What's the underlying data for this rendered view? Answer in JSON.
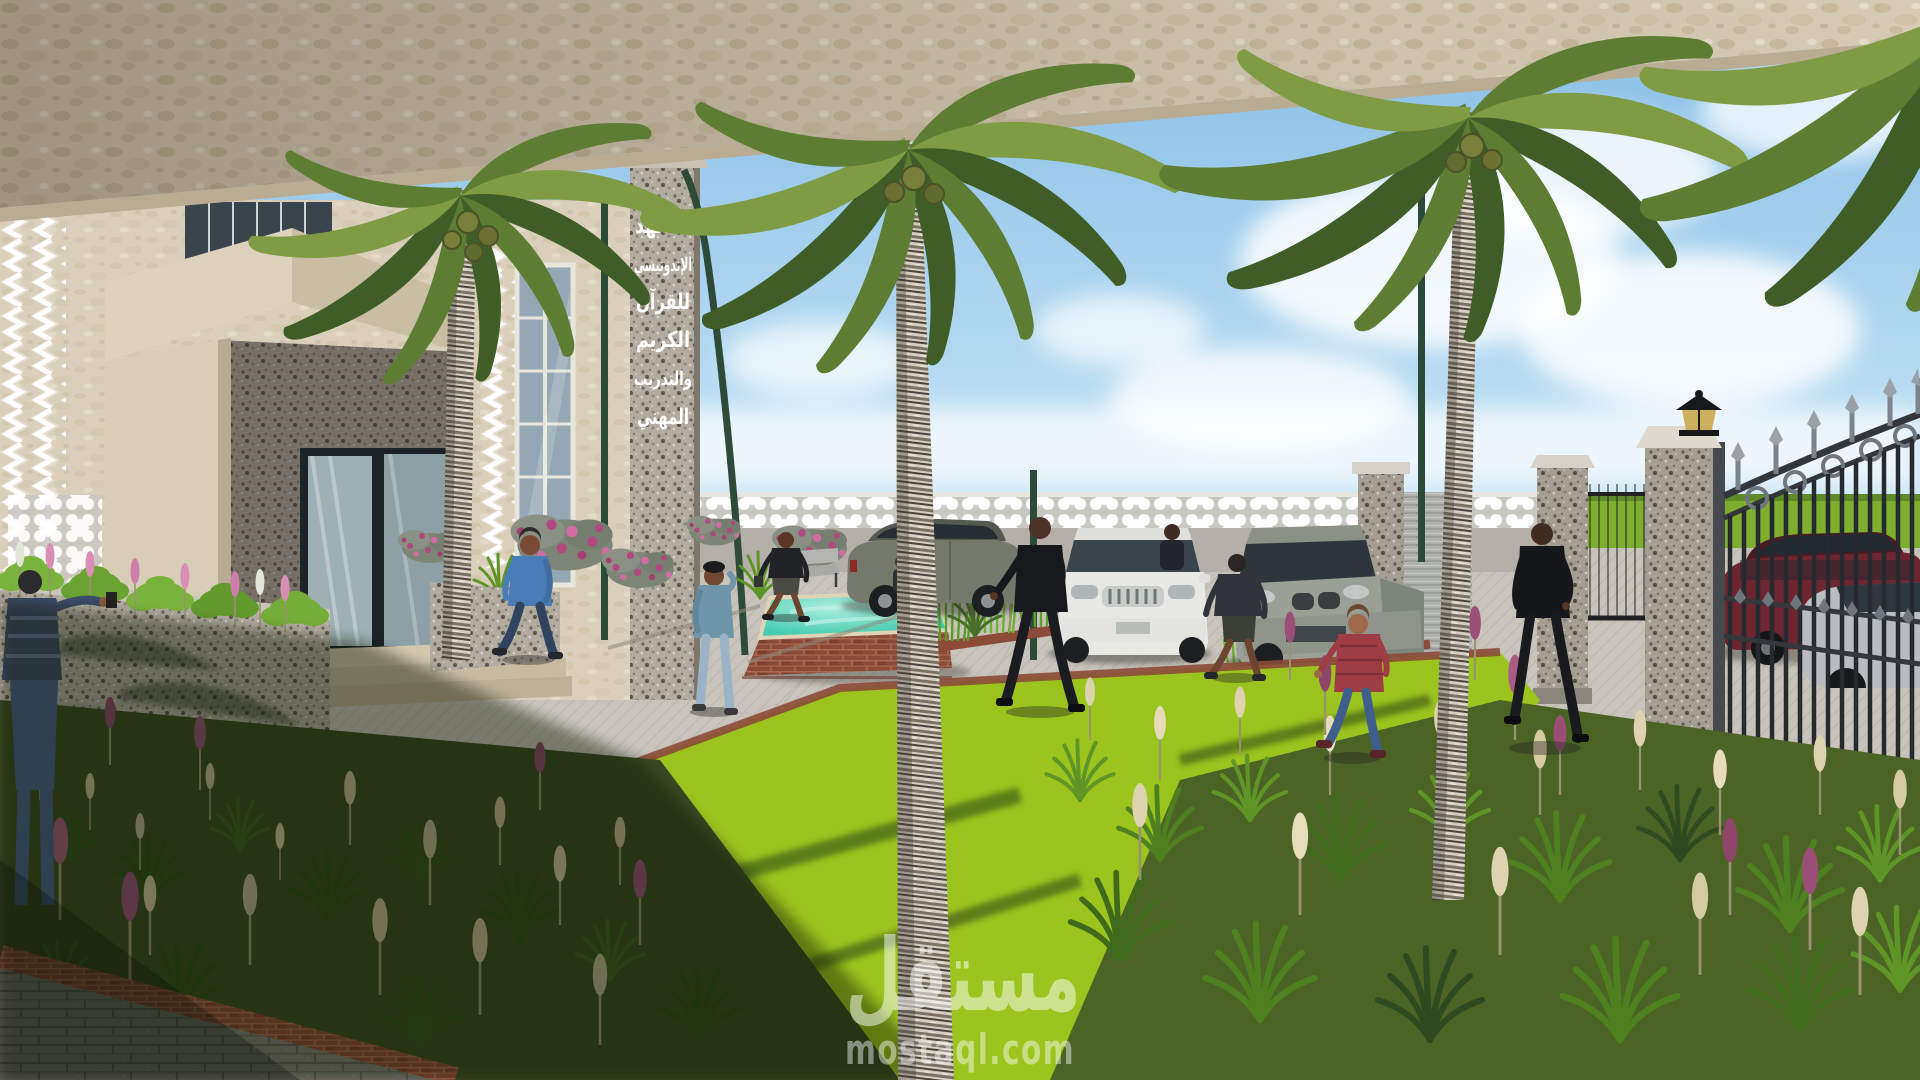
{
  "sign": {
    "words": [
      "المعهد",
      "الإندونيسي",
      "للقرآن",
      "الكريم",
      "والتدريب",
      "المهني"
    ]
  },
  "watermark": {
    "arabic": "مستقل",
    "latin": "mostaql.com"
  },
  "palette": {
    "sky_top": "#86bde6",
    "sky_horizon": "#e6f3fa",
    "cloud": "#ffffff",
    "canopy": "#d6cbb4",
    "travertine": "#d9cfba",
    "granite": "#b2aca0",
    "sign_text": "#ffffff",
    "wall": "#b4b0a9",
    "wall_band": "#ffffff",
    "pavement": "#c8c4bb",
    "plank_shade": "#7b7973",
    "brick": "#8c4a38",
    "lawn_sun": "#9cc41f",
    "lawn_shadow": "#2d4a12",
    "pool_water": "#37c3a8",
    "field_green": "#7fae2e",
    "road": "#b3b5b3",
    "fence_iron": "#26292d",
    "trunk_light": "#d5cfc2",
    "trunk_dark": "#6e6659",
    "frond_dark": "#3f5d26",
    "frond_mid": "#5d7d33",
    "frond_light": "#7f9c44",
    "plume_cream": "#ded3ae",
    "plume_purple": "#9b4f76",
    "bougainvillea": "#b1487f",
    "plant_green": "#6fa32c",
    "suv_olive": "#75796c",
    "suv_white": "#e8e9e5",
    "suv_gray": "#9aa096",
    "car_red": "#6d2530",
    "car_silver": "#b9bdc1",
    "watermark_color": "#ffffff"
  }
}
